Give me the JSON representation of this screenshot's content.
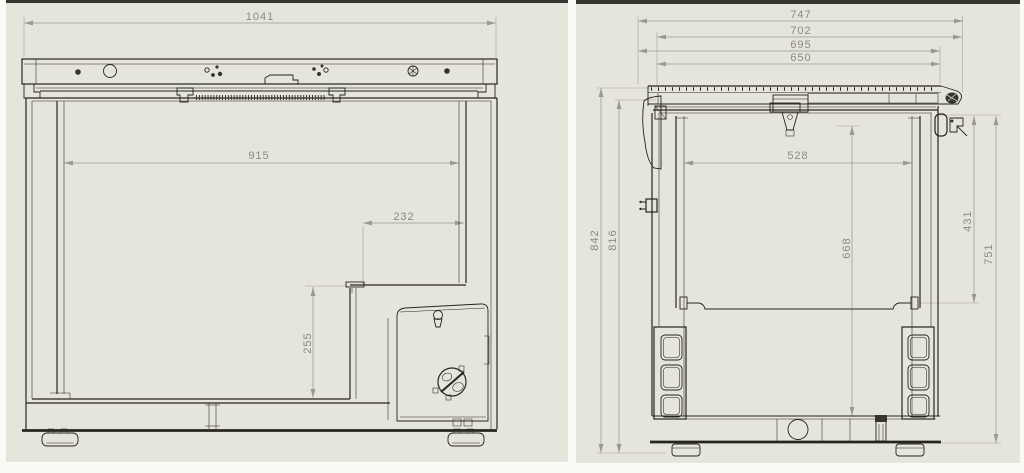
{
  "page": {
    "background_color": "#fafaf7",
    "panel_background": "#e6e5db",
    "stroke_color": "#26251f",
    "dimension_color": "#8b8a80"
  },
  "front_view": {
    "dimensions": {
      "overall_width": "1041",
      "interior_width": "915",
      "step_width": "232",
      "step_height": "255"
    }
  },
  "side_view": {
    "dimensions": {
      "overall_depth": "747",
      "lid_depth": "702",
      "body_depth": "695",
      "opening_depth": "650",
      "interior_depth": "528",
      "interior_height": "668",
      "rail_height": "431",
      "body_side_height": "751",
      "overall_height": "842",
      "cabinet_height": "816"
    }
  }
}
